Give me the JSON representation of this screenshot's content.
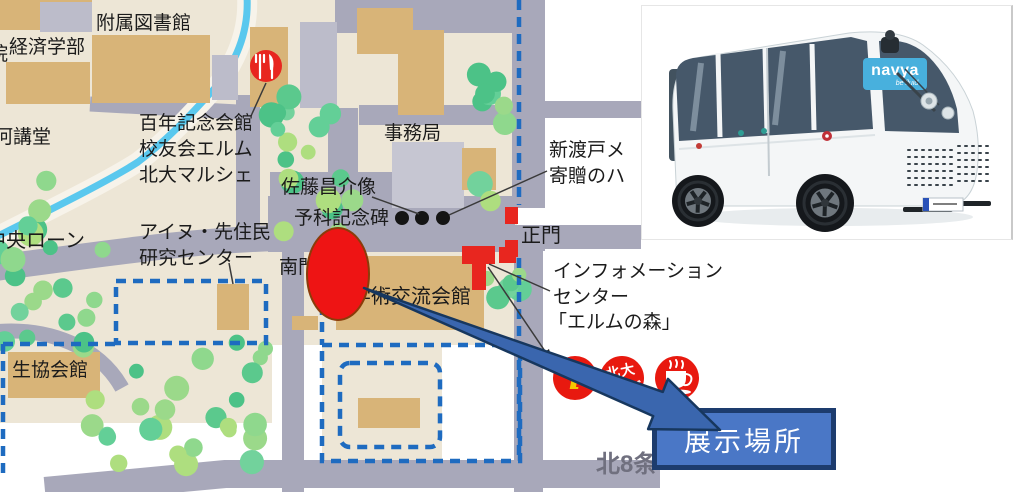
{
  "callout": {
    "label": "展示場所"
  },
  "bus_photo": {
    "brand": "navya",
    "tagline": "be fluid"
  },
  "map": {
    "labels": {
      "library": "附属図書館",
      "economics": "経済学部",
      "econ_partial": "院",
      "furukawa_hall": "河講堂",
      "centennial_1": "百年記念会館",
      "centennial_2": "校友会エルム",
      "centennial_3": "北大マルシェ",
      "admin_office": "事務局",
      "sato_statue": "佐藤昌介像",
      "yoka_monument": "予科記念碑",
      "main_gate": "正門",
      "nitobe_1": "新渡戸メ",
      "nitobe_2": "寄贈のハ",
      "info_center_1": "インフォメーション",
      "info_center_2": "センター",
      "info_center_3": "「エルムの森」",
      "central_lawn": "中央ローン",
      "ainu_1": "アイヌ・先住民",
      "ainu_2": "研究センター",
      "south_gate": "南門",
      "academic_hall": "学術交流会館",
      "coop_hall": "生協会館",
      "kita8": "北8条"
    },
    "icons": {
      "info_letter": "i",
      "goods_1": "北大",
      "goods_2": "グッズ"
    },
    "colors": {
      "accent_red": "#e8261f",
      "marker_red": "#ee1414",
      "callout_blue": "#4a77c6",
      "callout_border": "#1d3c6e",
      "arrow_blue": "#3a66ae",
      "boundary_blue": "#1e6bc0",
      "road_gray": "#a8a8ba",
      "ground_beige": "#ede6d6",
      "building_tan": "#d8b478",
      "stream_blue": "#5ac8ee",
      "logo_blue": "#48b0dd"
    }
  }
}
